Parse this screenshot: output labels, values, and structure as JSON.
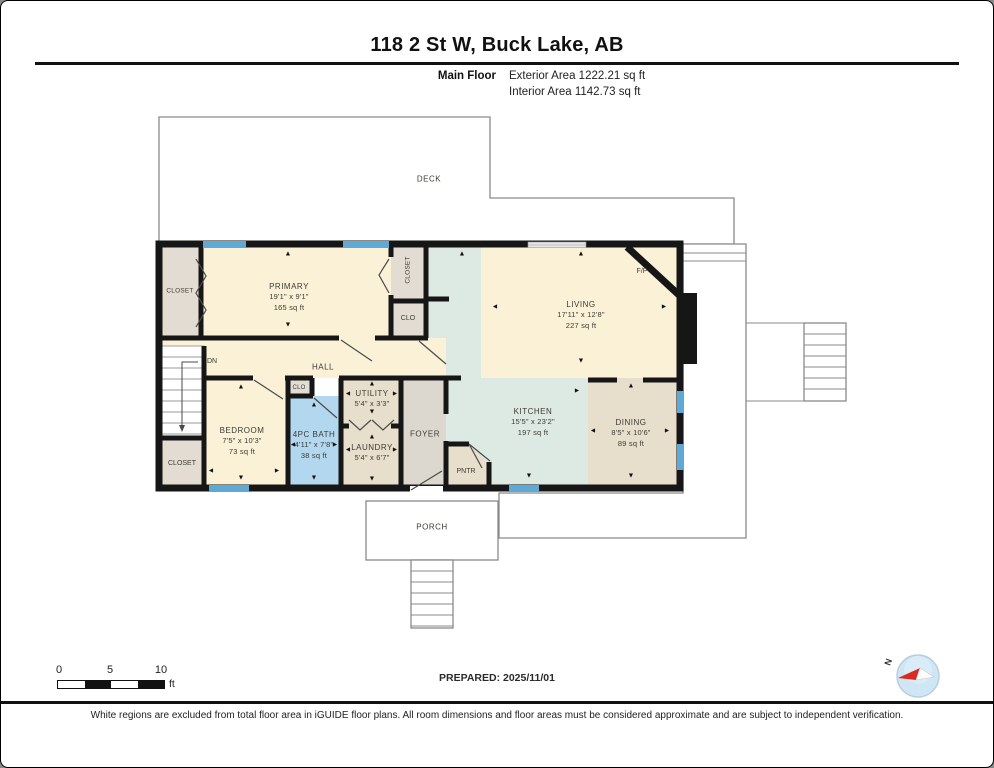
{
  "header": {
    "title": "118 2 St W, Buck Lake, AB",
    "floor_label": "Main Floor",
    "exterior_area": "Exterior Area 1222.21 sq ft",
    "interior_area": "Interior Area 1142.73 sq ft"
  },
  "rooms": {
    "deck": {
      "name": "DECK"
    },
    "porch": {
      "name": "PORCH"
    },
    "primary": {
      "name": "PRIMARY",
      "dims": "19'1\" x 9'1\"",
      "area": "165 sq ft"
    },
    "living": {
      "name": "LIVING",
      "dims": "17'11\" x 12'8\"",
      "area": "227 sq ft"
    },
    "kitchen": {
      "name": "KITCHEN",
      "dims": "15'5\" x 23'2\"",
      "area": "197 sq ft"
    },
    "dining": {
      "name": "DINING",
      "dims": "8'5\" x 10'6\"",
      "area": "89 sq ft"
    },
    "bedroom": {
      "name": "BEDROOM",
      "dims": "7'5\" x 10'3\"",
      "area": "73 sq ft"
    },
    "bath": {
      "name": "4PC BATH",
      "dims": "4'11\" x 7'8\"",
      "area": "38 sq ft"
    },
    "utility": {
      "name": "UTILITY",
      "dims": "5'4\" x 3'3\""
    },
    "laundry": {
      "name": "LAUNDRY",
      "dims": "5'4\" x 6'7\""
    },
    "hall": {
      "name": "HALL"
    },
    "foyer": {
      "name": "FOYER"
    },
    "pantry": {
      "name": "PNTR"
    },
    "fireplace": {
      "name": "F/P"
    },
    "stairs": {
      "down_label": "DN"
    },
    "closet_top_left": {
      "name": "CLOSET"
    },
    "closet_primary": {
      "name": "CLOSET"
    },
    "clo_primary": {
      "name": "CLO"
    },
    "clo_bedroom": {
      "name": "CLO"
    },
    "closet_bottom_left": {
      "name": "CLOSET"
    }
  },
  "icons": {
    "arrow_up": "▲",
    "arrow_down": "▼",
    "arrow_left": "◄",
    "arrow_right": "►",
    "compass_north": "N"
  },
  "scale_bar": {
    "tick0": "0",
    "tick5": "5",
    "tick10": "10",
    "unit": "ft"
  },
  "footer": {
    "prepared": "PREPARED: 2025/11/01",
    "disclaimer": "White regions are excluded from total floor area in iGUIDE floor plans. All room dimensions and floor areas must be considered approximate and are subject to independent verification."
  },
  "colors": {
    "room_cream": "#FAF1D7",
    "kitchen_teal": "#DCEAE3",
    "dining_beige": "#E8DECC",
    "bath_blue": "#B3D7EF",
    "closet_gray": "#E2DCD2",
    "foyer_gray": "#DDD8CF",
    "window_blue": "#5FA9D6",
    "wall_black": "#161616"
  }
}
